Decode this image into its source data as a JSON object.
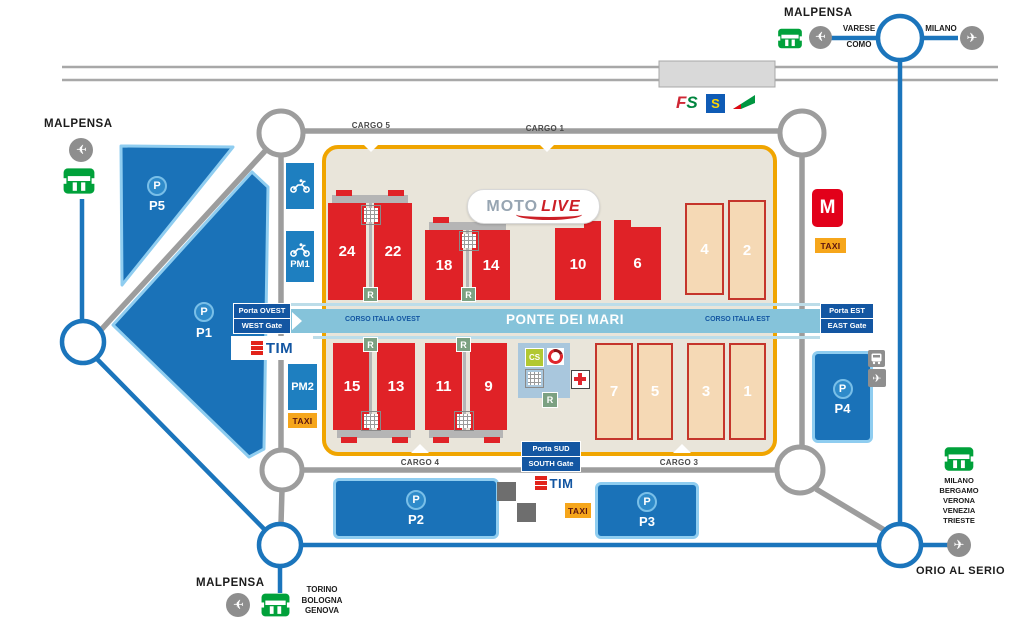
{
  "external": {
    "malpensa": "MALPENSA",
    "varese": "VARESE",
    "como": "COMO",
    "milano": "MILANO",
    "orio": "ORIO AL SERIO",
    "sw_dests": [
      "TORINO",
      "BOLOGNA",
      "GENOVA"
    ],
    "se_dests": [
      "MILANO",
      "BERGAMO",
      "VERONA",
      "VENEZIA",
      "TRIESTE"
    ]
  },
  "venue": {
    "cargo": {
      "c5": "CARGO 5",
      "c1": "CARGO 1",
      "c4": "CARGO 4",
      "c3": "CARGO 3"
    },
    "gates": {
      "west": {
        "line1": "Porta OVEST",
        "line2": "WEST Gate"
      },
      "east": {
        "line1": "Porta EST",
        "line2": "EAST Gate"
      },
      "south": {
        "line1": "Porta SUD",
        "line2": "SOUTH Gate"
      }
    },
    "axis": {
      "west": "CORSO ITALIA OVEST",
      "center": "PONTE DEI MARI",
      "east": "CORSO ITALIA EST"
    },
    "pav_red": [
      "24",
      "22",
      "18",
      "14",
      "10",
      "6",
      "15",
      "13",
      "11",
      "9"
    ],
    "pav_tan": [
      "4",
      "2",
      "7",
      "5",
      "3",
      "1"
    ],
    "motolive": {
      "moto": "MOTO",
      "live": "LIVE"
    },
    "services": {
      "cs": "CS",
      "restaurant": "R"
    }
  },
  "parking": {
    "symbol": "P",
    "p5": "P5",
    "p1": "P1",
    "p2": "P2",
    "p3": "P3",
    "p4": "P4",
    "pm1": "PM1",
    "pm2": "PM2"
  },
  "transport": {
    "taxi": "TAXI",
    "metro": "M",
    "tim": "TIM",
    "s_line": "S"
  },
  "colors": {
    "road_blue": "#1b75bc",
    "road_grey": "#9d9d9d",
    "venue_border": "#f0a500",
    "venue_bg": "#e9e5da",
    "pavilion_red": "#e02227",
    "pavilion_tan": "#f5d9b5",
    "band_blue": "#85c3da",
    "gate_blue": "#1356a2",
    "parking_blue": "#1a72b8",
    "green": "#00a13a",
    "taxi_orange": "#f6a61b",
    "metro_red": "#e2001a"
  }
}
